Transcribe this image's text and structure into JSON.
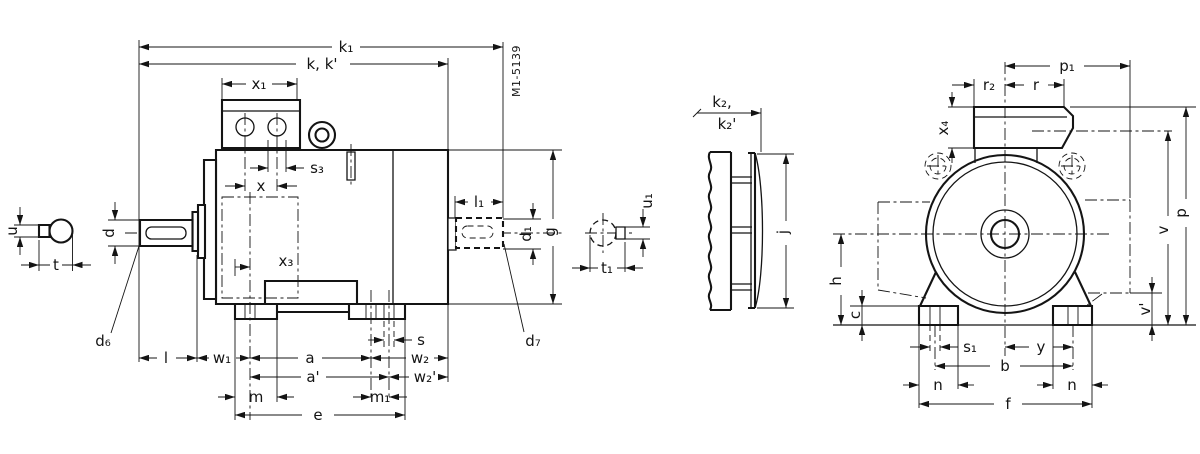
{
  "drawing": {
    "ref_code": "M1-5139",
    "side_view": {
      "k1": "k₁",
      "k": "k, k'",
      "x1": "x₁",
      "s3": "s₃",
      "x": "x",
      "x3": "x₃",
      "u": "u",
      "t": "t",
      "d": "d",
      "d6": "d₆",
      "l": "l",
      "w1": "w₁",
      "a": "a",
      "a_p": "a'",
      "m": "m",
      "m1": "m₁",
      "e": "e",
      "s": "s",
      "w2": "w₂",
      "w2_p": "w₂'",
      "l1": "l₁",
      "d1": "d₁",
      "g": "g",
      "d7": "d₇",
      "u1": "u₁",
      "t1": "t₁"
    },
    "end_view": {
      "k2": "k₂,",
      "k2_p": "k₂'",
      "j": "j"
    },
    "front_view": {
      "p1": "p₁",
      "r2": "r₂",
      "r": "r",
      "x4": "x₄",
      "v": "v",
      "p": "p",
      "v_p": "v'",
      "h": "h",
      "c": "c",
      "s1": "s₁",
      "y": "y",
      "b": "b",
      "n_left": "n",
      "n_right": "n",
      "f": "f"
    }
  }
}
